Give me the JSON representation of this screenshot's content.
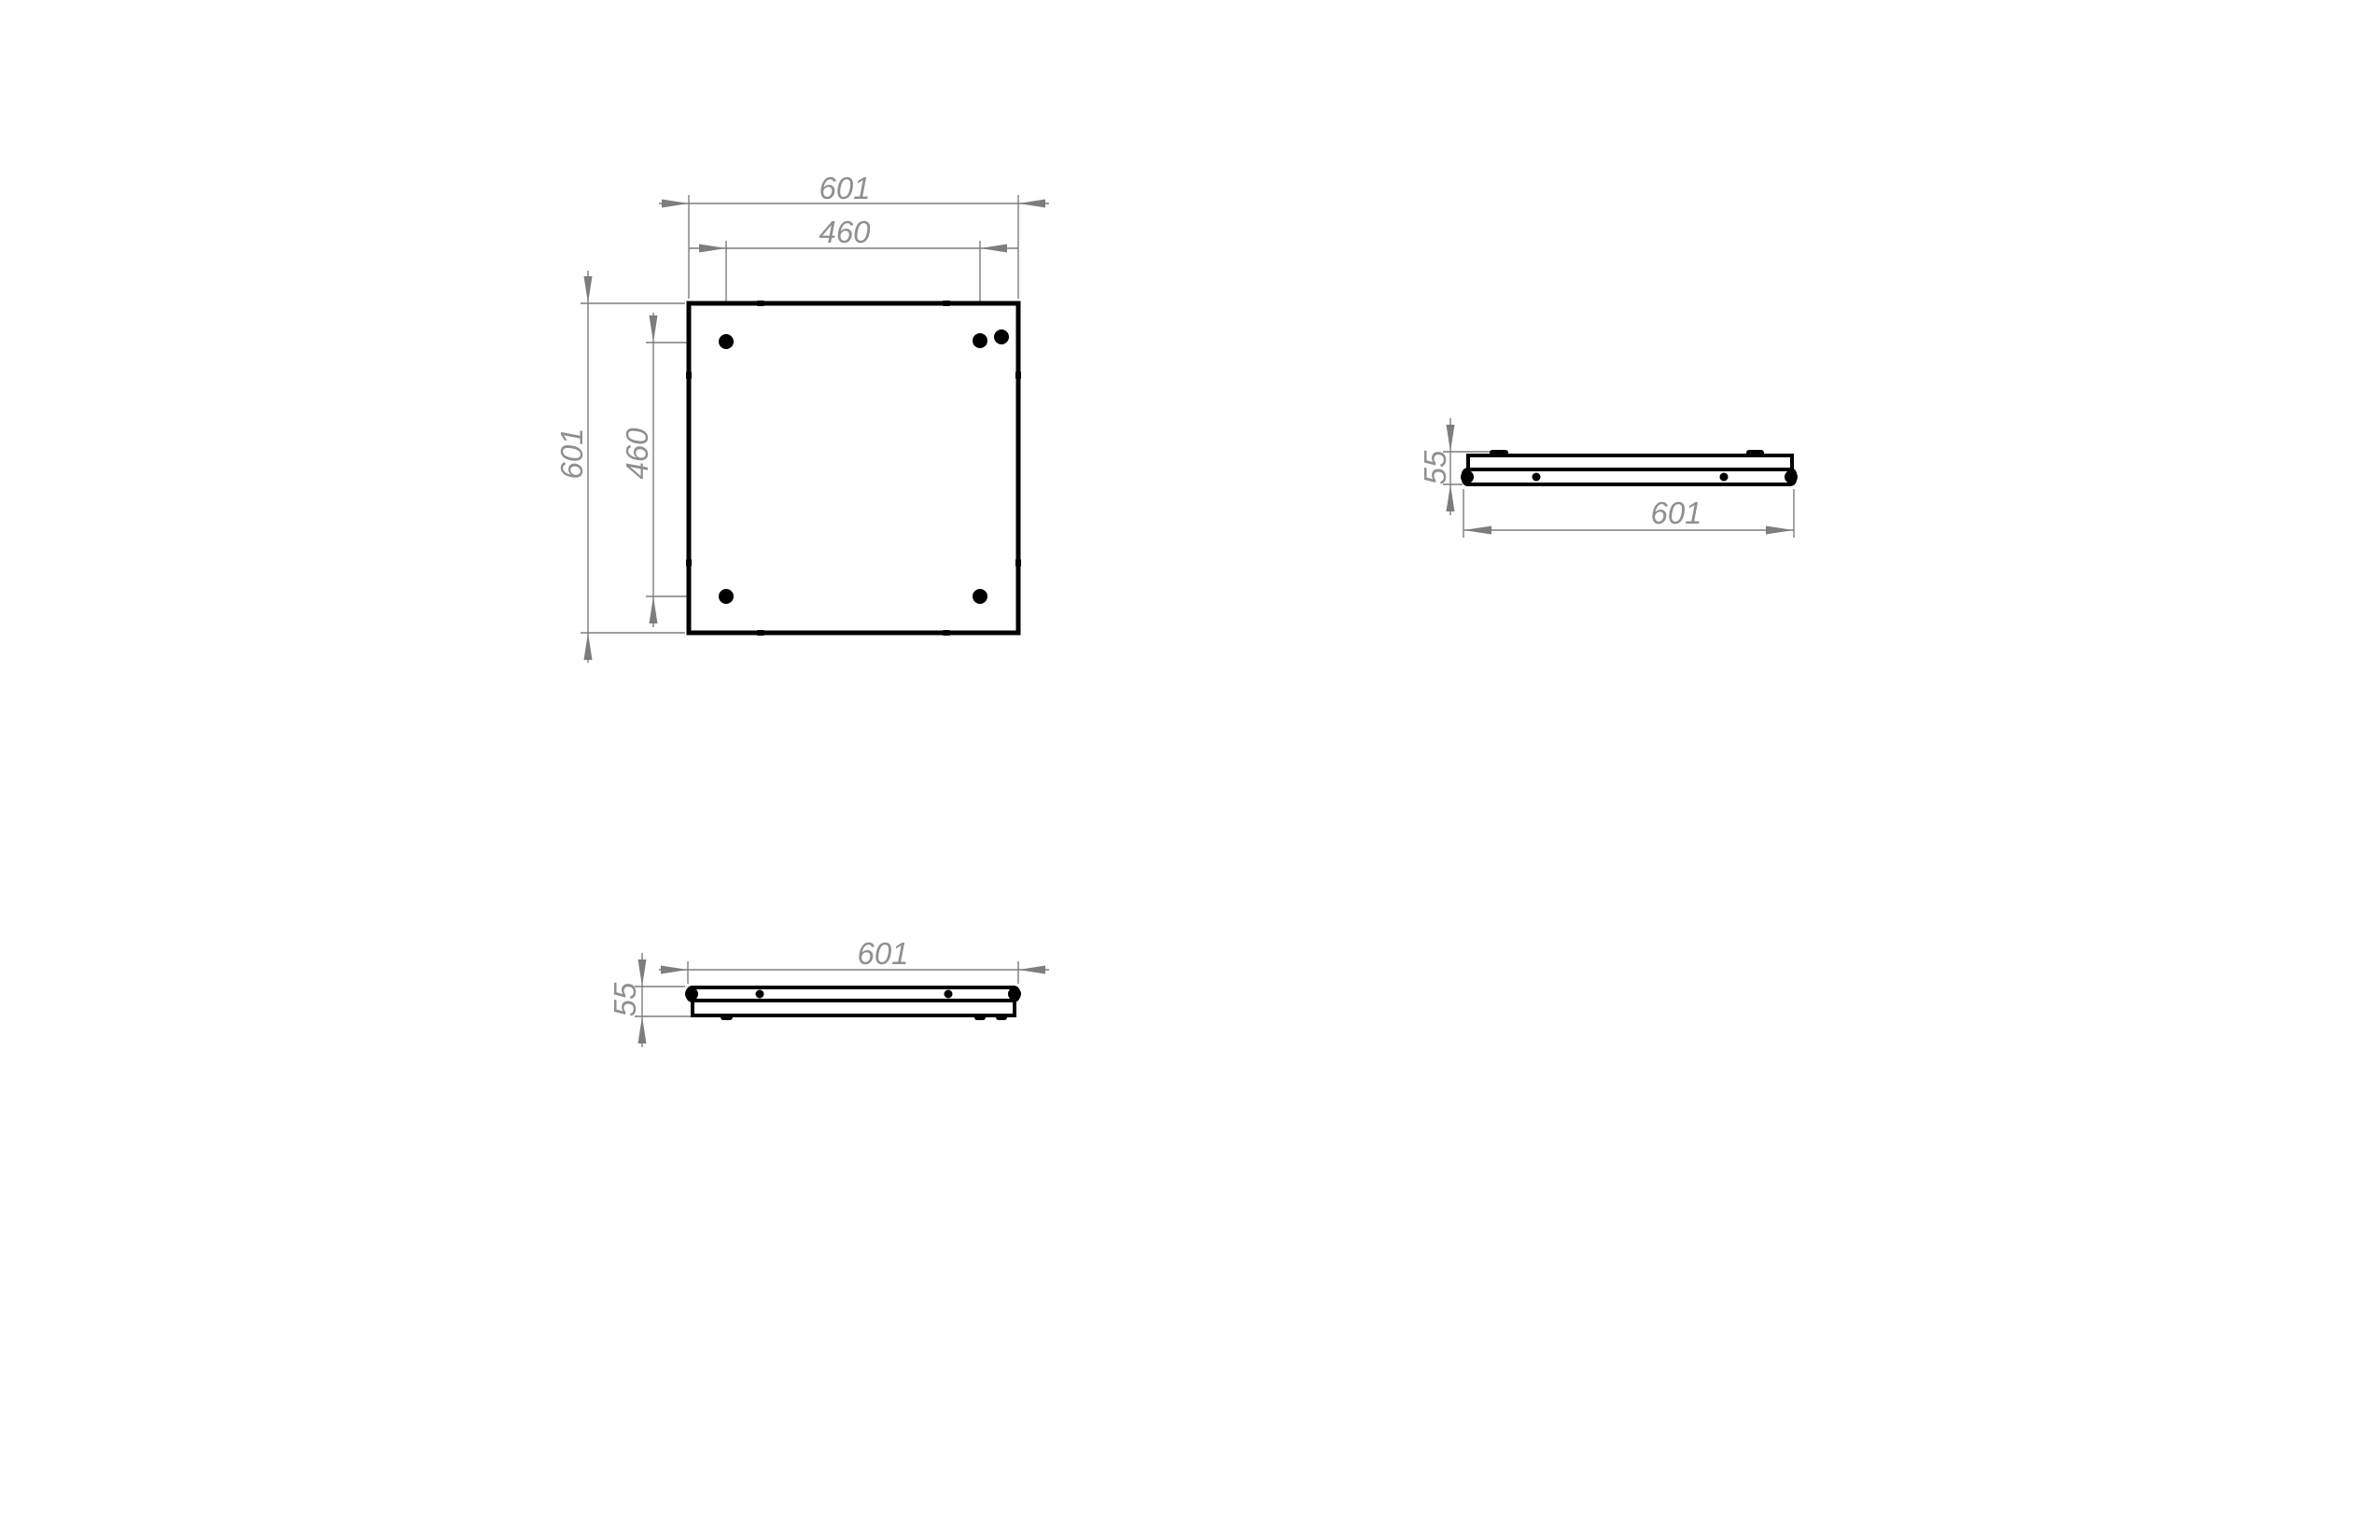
{
  "drawing": {
    "views": {
      "top": {
        "dims": {
          "outer_width": "601",
          "hole_spacing_x": "460",
          "outer_height": "601",
          "hole_spacing_y": "460"
        }
      },
      "side": {
        "dims": {
          "thickness": "55",
          "outer_width": "601"
        }
      },
      "front": {
        "dims": {
          "thickness": "55",
          "outer_width": "601"
        }
      }
    },
    "colors": {
      "part_outline": "#000000",
      "dimension_lines": "#7d7d7d",
      "dimension_text": "#8f8f8f",
      "background": "#ffffff"
    }
  }
}
